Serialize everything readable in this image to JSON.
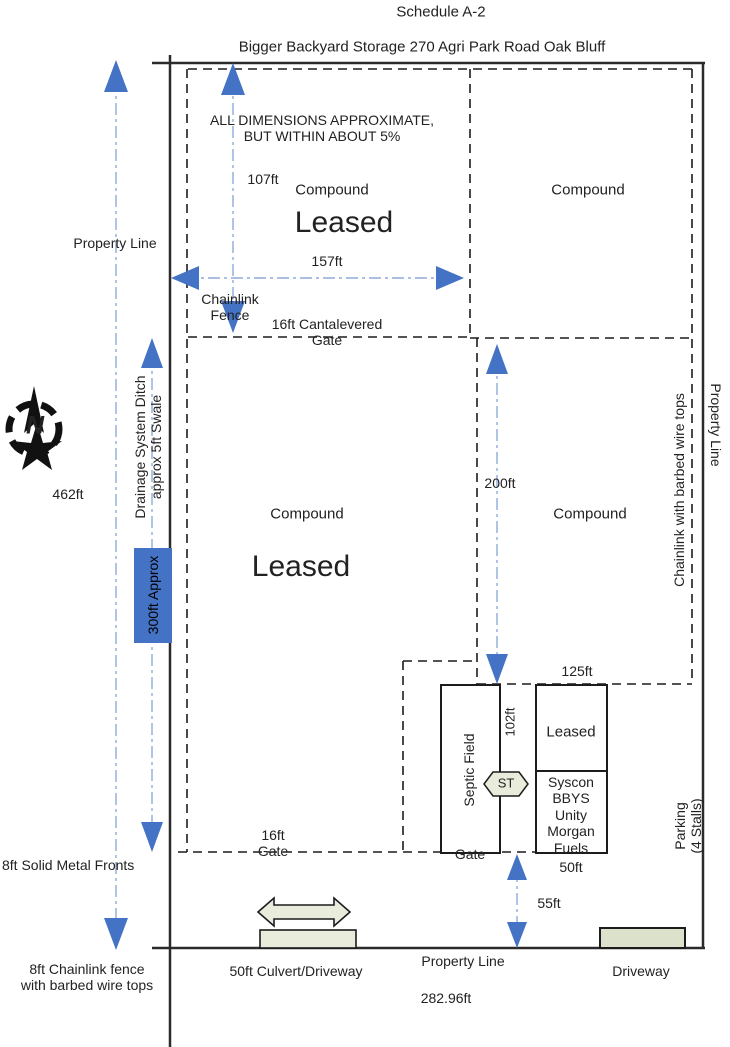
{
  "header": {
    "title": "Schedule A-2",
    "subtitle": "Bigger Backyard Storage 270 Agri Park Road Oak Bluff"
  },
  "note": {
    "l1": "ALL DIMENSIONS APPROXIMATE,",
    "l2": "BUT WITHIN ABOUT 5%"
  },
  "compass": {
    "n": "N"
  },
  "left": {
    "property_line": "Property Line",
    "d462": "462ft",
    "drainage1": "Drainage System Ditch",
    "drainage2": "approx 5ft Swale",
    "d300": "300ft Approx",
    "solid_fronts": "8ft Solid Metal Fronts",
    "chainlink1": "8ft Chainlink fence",
    "chainlink2": "with barbed wire tops"
  },
  "tl": {
    "d107": "107ft",
    "compound": "Compound",
    "leased": "Leased",
    "d157": "157ft",
    "fence1": "Chainlink",
    "fence2": "Fence",
    "gate1": "16ft Cantalevered",
    "gate2": "Gate"
  },
  "tr": {
    "compound": "Compound"
  },
  "center": {
    "compound": "Compound",
    "leased": "Leased"
  },
  "right": {
    "d200": "200ft",
    "compound": "Compound",
    "chainlink": "Chainlink with barbed wire tops",
    "property_line": "Property Line",
    "d125": "125ft",
    "parking1": "Parking",
    "parking2": "(4 Stalls)"
  },
  "septic": {
    "field": "Septic Field",
    "d102": "102ft",
    "st": "ST",
    "gate": "Gate",
    "leased": "Leased",
    "tenants": [
      "Syscon",
      "BBYS",
      "Unity",
      "Morgan",
      "Fuels"
    ],
    "d50": "50ft"
  },
  "bottom": {
    "gate1": "16ft",
    "gate2": "Gate",
    "d55": "55ft",
    "culvert": "50ft Culvert/Driveway",
    "property_line": "Property Line",
    "frontage": "282.96ft",
    "driveway": "Driveway"
  },
  "colors": {
    "arrow": "#4472c4",
    "dashline": "#8faadc",
    "beige": "#e9ecdb",
    "beige2": "#dbe1ca",
    "ink": "#222222"
  }
}
